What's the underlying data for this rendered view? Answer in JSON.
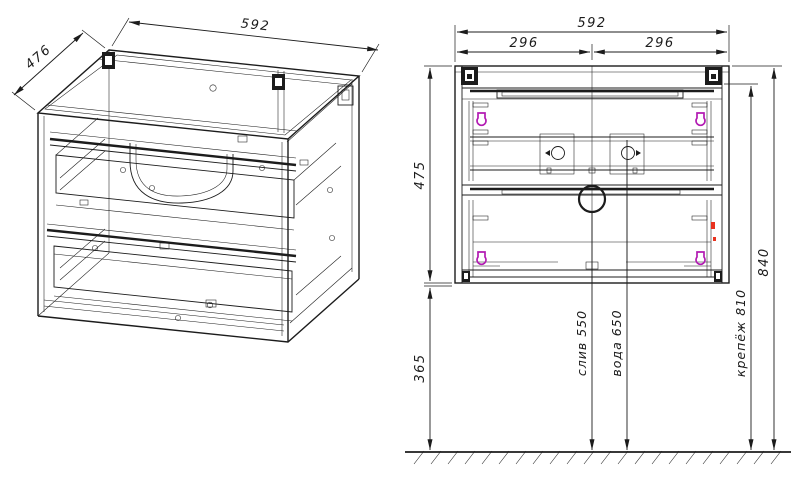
{
  "iso_view": {
    "dim_width": "592",
    "dim_depth": "476"
  },
  "front_view": {
    "dim_width": "592",
    "dim_left_half": "296",
    "dim_right_half": "296",
    "dim_cabinet_height": "475",
    "dim_floor_clearance": "365",
    "dim_overall_height": "840",
    "dim_mounting": "крепёж 810",
    "dim_drain": "слив 550",
    "dim_water": "вода 650"
  },
  "colors": {
    "line": "#1c1c1c",
    "clip_magenta": "#b21ab2",
    "mark_red": "#e8321e",
    "background": "#ffffff"
  }
}
